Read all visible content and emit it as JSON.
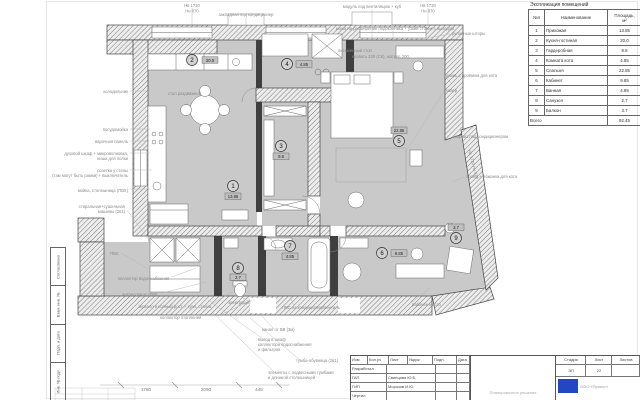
{
  "explication": {
    "title": "Экспликация помещений",
    "col_num": "№п",
    "col_name": "Наименование",
    "col_area1": "Площадь,",
    "col_area2": "м²",
    "total_label": "Всего",
    "total_value": "92.45"
  },
  "rooms": [
    {
      "num": "1",
      "name": "Прихожая",
      "area": "13.85"
    },
    {
      "num": "2",
      "name": "Кухня-гостиная",
      "area": "20.0"
    },
    {
      "num": "3",
      "name": "Гардеробная",
      "area": "9.8"
    },
    {
      "num": "4",
      "name": "Комната кота",
      "area": "4.85"
    },
    {
      "num": "5",
      "name": "Спальня",
      "area": "22.85"
    },
    {
      "num": "6",
      "name": "Кабинет",
      "area": "9.85"
    },
    {
      "num": "7",
      "name": "Ванная",
      "area": "4.85"
    },
    {
      "num": "8",
      "name": "Санузел",
      "area": "2.7"
    },
    {
      "num": "9",
      "name": "Балкон",
      "area": "3.7"
    }
  ],
  "titleblock": {
    "cols": [
      "Изм",
      "Кол.уч",
      "Лист",
      "№док",
      "Подп.",
      "Дата"
    ],
    "row_labels": [
      "Разработал",
      "ГАП",
      "ГИП",
      "Чертил"
    ],
    "gap_name": "Свинцова Ю.Б.",
    "gip_name": "Морозов И.Ю.",
    "stage_label": "Стадия",
    "sheet_label": "Лист",
    "sheets_label": "Листов",
    "stage": "ЭП",
    "sheet": "22",
    "company": "ООО «Проект»",
    "doc_note": "Планировочное решение"
  },
  "frame": {
    "labels": [
      "Согласовано",
      "Взам. инв. №",
      "Подп. и дата",
      "Инв. № подл."
    ]
  },
  "dimensions": {
    "d1": "1780",
    "d2": "2090",
    "d3": "445"
  },
  "annotations": {
    "nv1a": "Нв 1720",
    "nv1b": "Нн 870",
    "nv2a": "Нв 1720",
    "nv2b": "Нн 870",
    "nv3": "Нв 1720  Нн 870",
    "cond_top": "закладная под кондиционер",
    "module": "модуль под вентиляцию + куб",
    "nisha": "ниша на расширение подоконника + узкий столик с выходом",
    "curtain": "рулонные шторы",
    "catdoor": "дверь с проёмом для кота",
    "kover": "ковёр",
    "karniz": "карниз под кондиционером",
    "lezhanka": "проём + лежанка для кота",
    "workplace": "рабочее место",
    "pism": "письменный стол",
    "bed_note": "кровать 220 (СК), матрас 200",
    "table_note": "стол раздвижной",
    "fridge": "холодильник",
    "dishwasher": "посудомойка",
    "hob": "варочная панель",
    "oven1": "духовой шкаф + микроволновка,",
    "oven2": "ниша для полки",
    "sockets1": "розетки у стены",
    "sockets2": "(там могут быть рамки) + выключатель",
    "sink": "мойка, столешница (ПВХ)",
    "washer1": "стиральная+сушильная",
    "washer2": "машины (2в1)",
    "pvs": "ПВС",
    "coll_water": "коллектор водоснабжения",
    "antresol": "антресоли Н 2080",
    "mirror": "зеркало в полный рост + туал. столик",
    "coll_heat": "коллектор отопления",
    "el": "электрощит",
    "pvs_cond": "ПВС на кондиционер/вентиль",
    "kanal": "канал от ВВ (3м)",
    "vyvod1": "вывод в шкаф",
    "vyvod2": "коллектора водоснабжения",
    "vyvod3": "и фильтров",
    "tumba": "тумба-обувница (2в1)",
    "elem1": "элементы с подвесными тумбами",
    "elem2": "и длинной столешницей"
  }
}
